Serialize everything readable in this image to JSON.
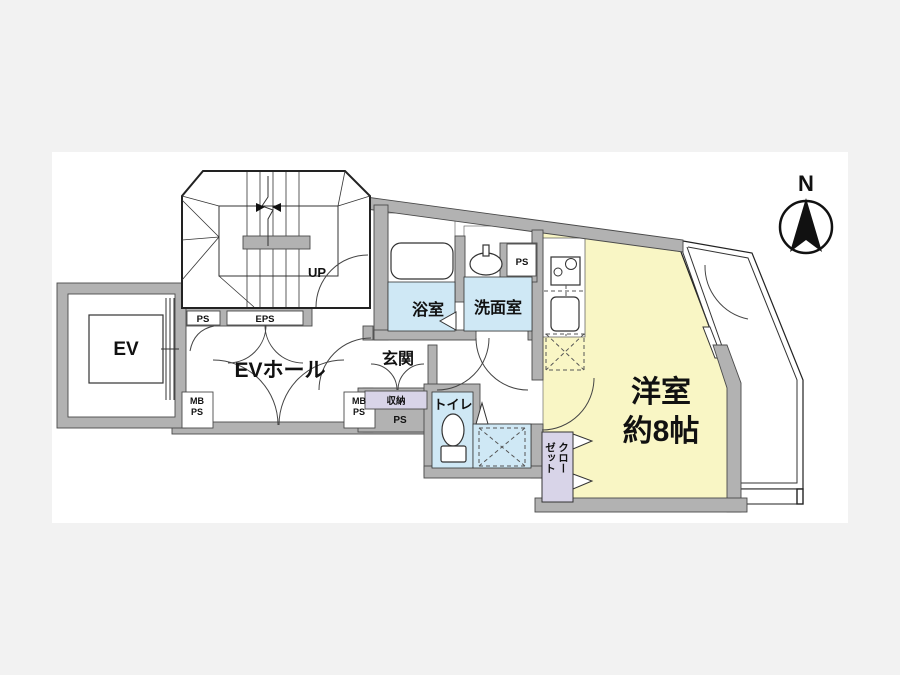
{
  "page": {
    "background_color": "#f2f2f2",
    "canvas_color": "#ffffff"
  },
  "colors": {
    "room_yellow": "#f9f6c5",
    "wet_area_blue": "#cfe8f5",
    "closet_lavender": "#d8d4e8",
    "wall_gray": "#b2b2b2",
    "line_black": "#222222"
  },
  "compass": {
    "north_label": "N"
  },
  "rooms": {
    "main_room": {
      "name_line1": "洋室",
      "size_line2": "約8帖"
    },
    "ev_hall": {
      "label": "EVホール"
    },
    "elevator": {
      "label": "EV"
    },
    "bathroom": {
      "label": "浴室"
    },
    "washroom": {
      "label": "洗面室"
    },
    "entrance": {
      "label": "玄関"
    },
    "toilet": {
      "label": "トイレ"
    },
    "storage": {
      "label": "収納"
    },
    "closet": {
      "label": "クローゼット",
      "column_right": "クロー",
      "column_left": "ゼット"
    },
    "stairs": {
      "direction_label": "UP"
    }
  },
  "service_labels": {
    "ps_stairwell": "PS",
    "eps": "EPS",
    "ps_washroom": "PS",
    "ps_under_storage": "PS",
    "mb_left": {
      "line1": "MB",
      "line2": "PS"
    },
    "mb_right": {
      "line1": "MB",
      "line2": "PS"
    }
  }
}
